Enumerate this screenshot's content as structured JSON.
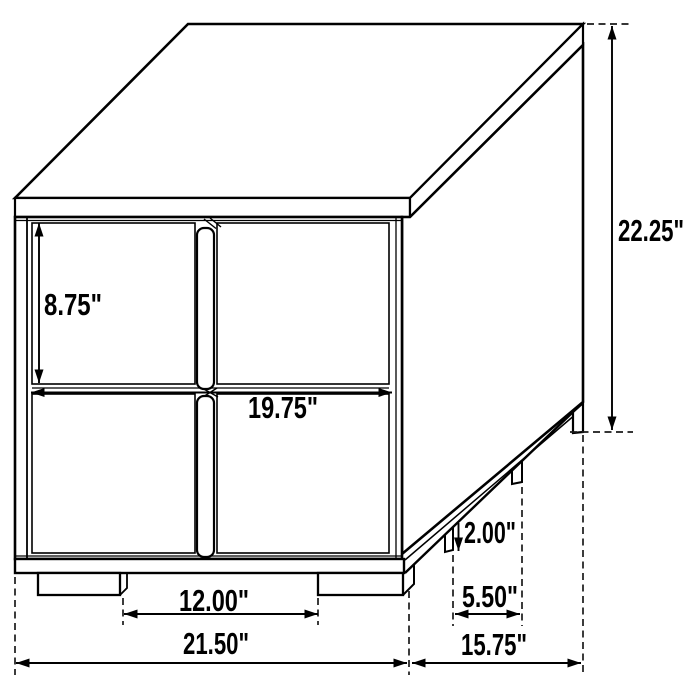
{
  "diagram": {
    "subject": "two-drawer nightstand dimension line drawing, three-quarter view",
    "background_color": "#ffffff",
    "line_color": "#000000",
    "labels": {
      "overall_height": "22.25\"",
      "drawer_front_height": "8.75\"",
      "drawer_front_width": "19.75\"",
      "leg_height": "2.00\"",
      "side_leg_spacing": "5.50\"",
      "front_leg_spacing": "12.00\"",
      "overall_width": "21.50\"",
      "overall_depth": "15.75\""
    }
  }
}
